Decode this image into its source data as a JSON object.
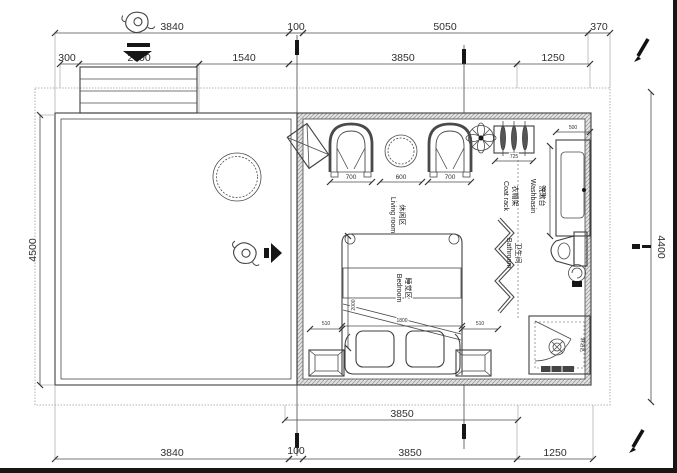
{
  "plan": {
    "dims": {
      "top1": [
        "3840",
        "100",
        "5050",
        "370"
      ],
      "top2": [
        "300",
        "2000",
        "1540",
        "3850",
        "1250"
      ],
      "bottomA": [
        "3850"
      ],
      "bottomB": [
        "3840",
        "100",
        "3850",
        "1250"
      ],
      "left_height": "4500",
      "right_height": "4400",
      "seat_left": "700",
      "table": "600",
      "seat_right": "700",
      "coat_rack": "725",
      "basin_width": "500",
      "basin_depth": "1000",
      "bed_width": "1800",
      "bed_length": "2000",
      "stand_left": "510",
      "stand_right": "510"
    },
    "rooms": {
      "living": {
        "zh": "休闲区",
        "en": "Living room"
      },
      "bedroom": {
        "zh": "睡觉区",
        "en": "Bedroom"
      },
      "washbasin": {
        "zh": "洗漱台",
        "en": "Washbasin"
      },
      "coat_rack": {
        "zh": "衣帽架",
        "en": "Coat rack"
      },
      "bathroom": {
        "zh": "卫生间",
        "en": "Bathroom"
      },
      "shower": {
        "zh": "淋浴区"
      }
    },
    "colors": {
      "line": "#3f3f3f",
      "dim_text": "#2f2f2f",
      "wall_fill": "#e2e2e2",
      "boundary": "#9b9b9b"
    }
  }
}
